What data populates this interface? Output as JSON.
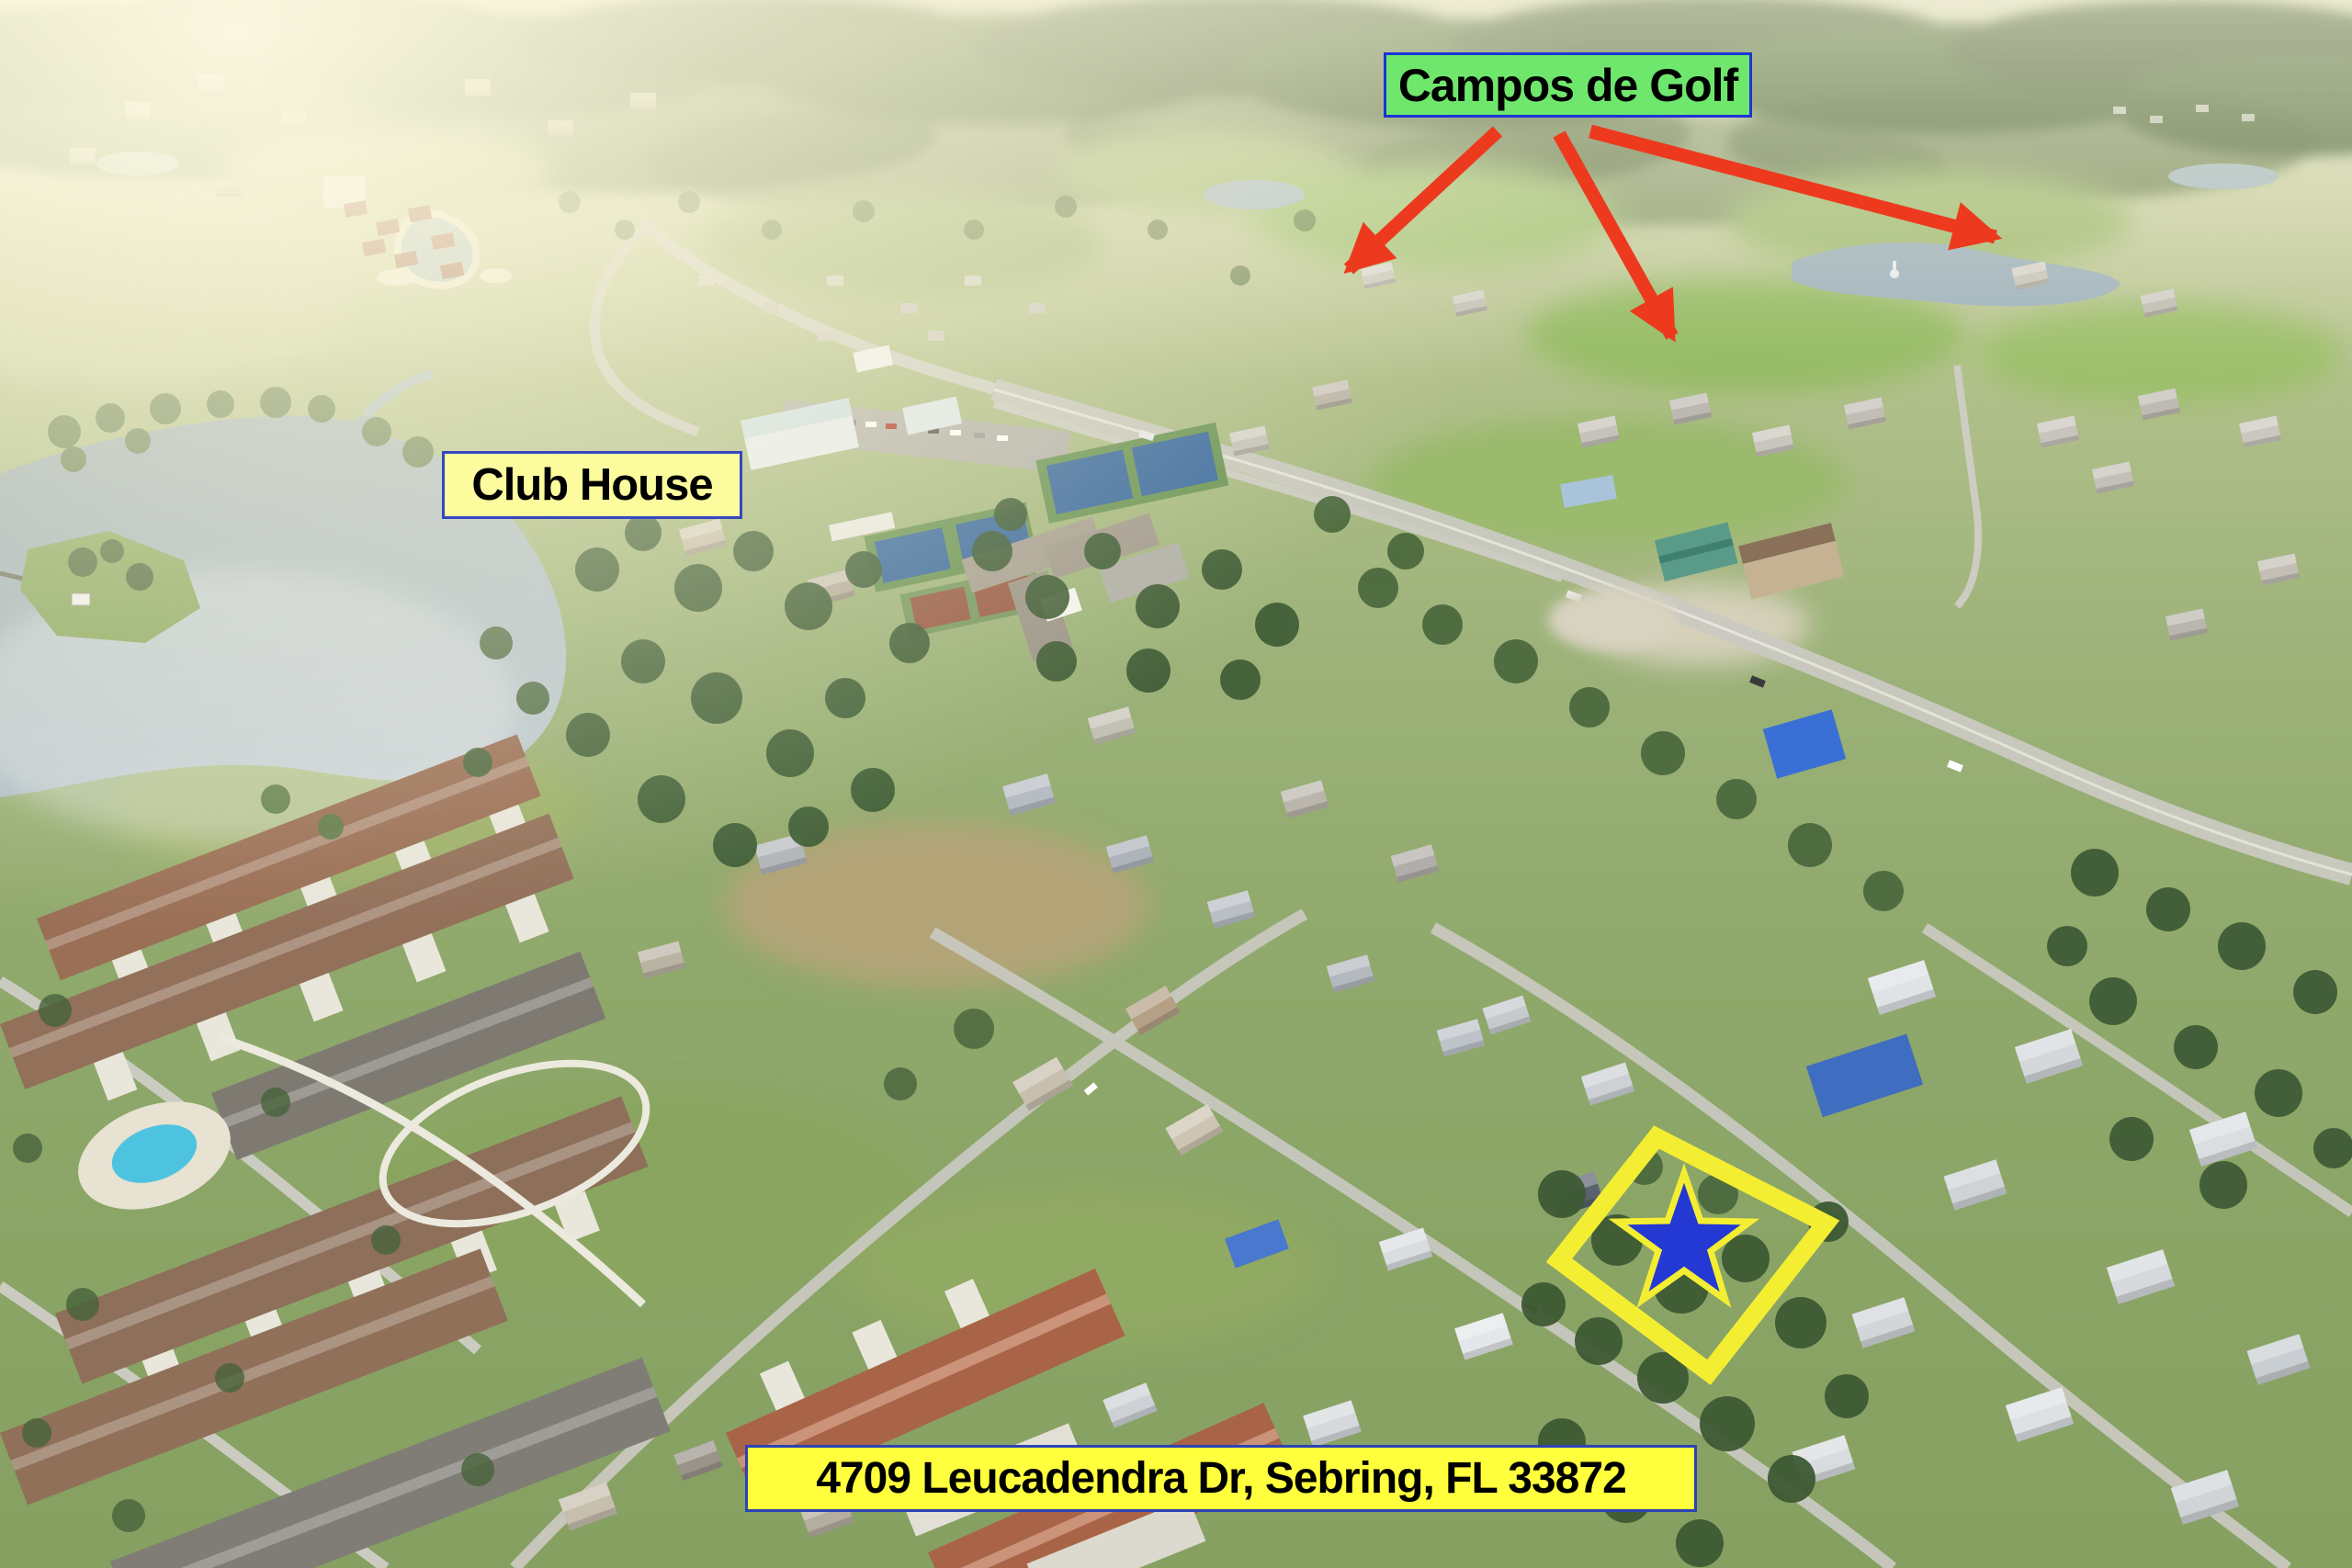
{
  "annotations": {
    "golf_label": {
      "text": "Campos de Golf",
      "bg_color": "#6fe76d",
      "border_color": "#1c36d2",
      "text_color": "#000000"
    },
    "club_house_label": {
      "text": "Club House",
      "bg_color": "#fcfc9e",
      "border_color": "#3448c0",
      "text_color": "#000000"
    },
    "address_label": {
      "text": "4709 Leucadendra Dr, Sebring, FL 33872",
      "bg_color": "#ffff3d",
      "border_color": "#2d43b5",
      "text_color": "#000000"
    },
    "arrows": {
      "color": "#ed3a1e",
      "count": "3"
    },
    "property_marker": {
      "star_color": "#2438d4",
      "outline_color": "#f4ee32"
    }
  }
}
